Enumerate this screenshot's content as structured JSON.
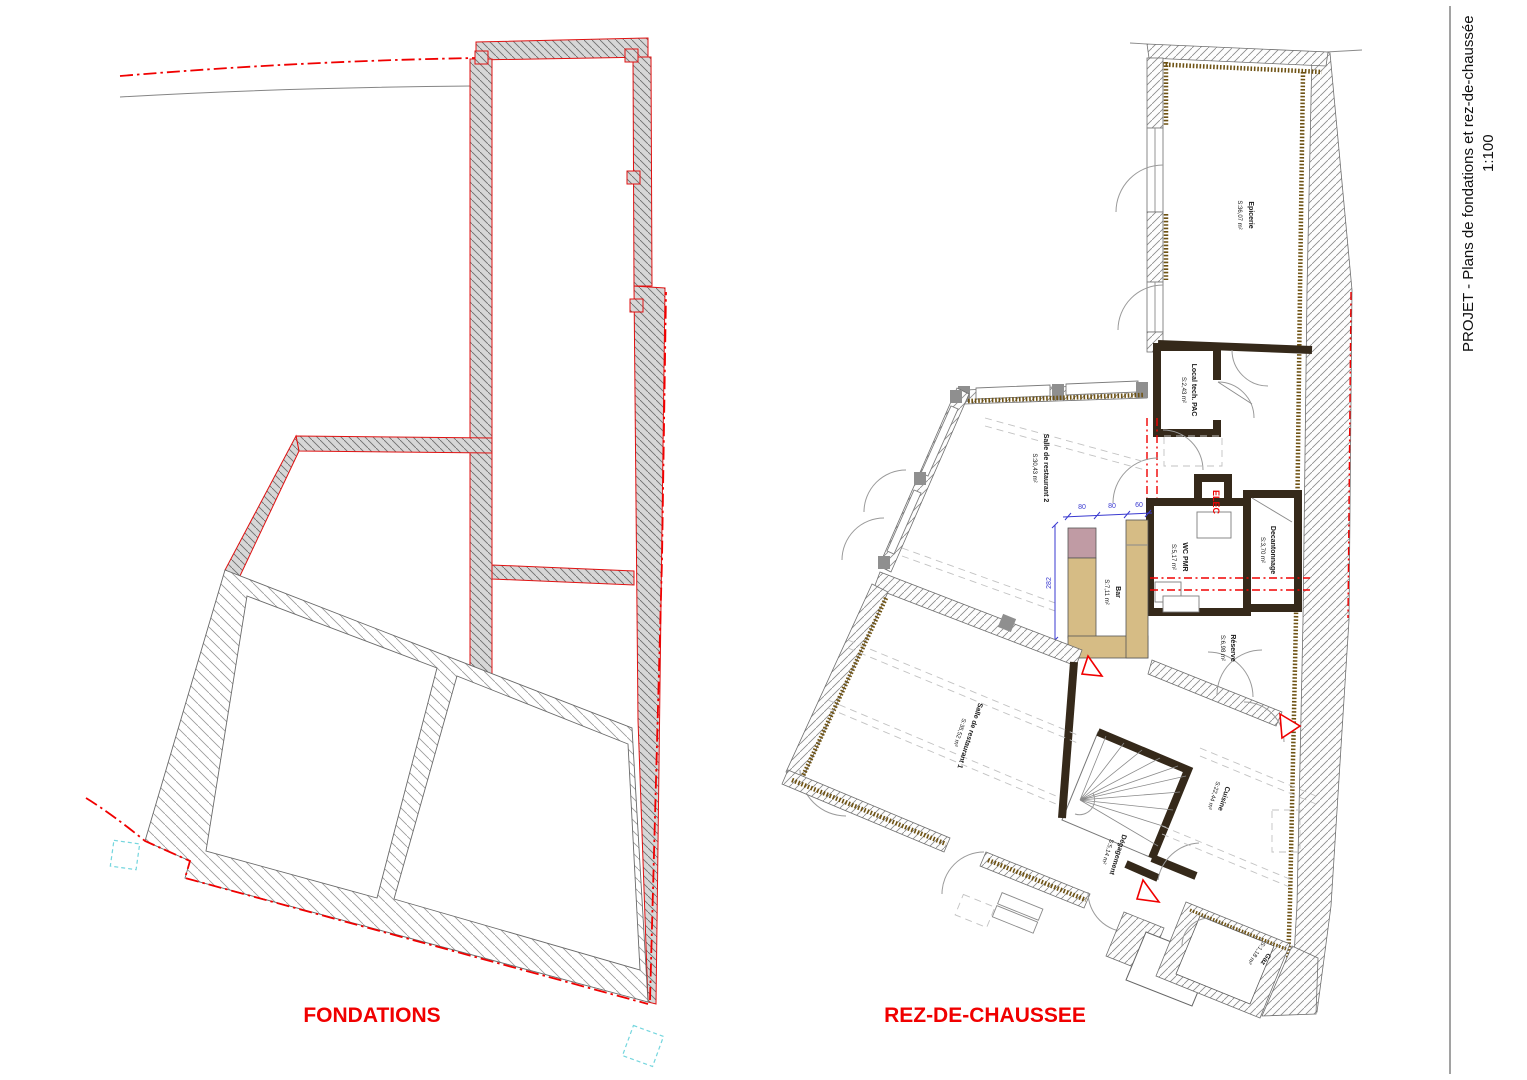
{
  "title_block": {
    "project_title": "PROJET - Plans de fondations et rez-de-chaussée",
    "scale_label": "1:100"
  },
  "plan_labels": {
    "fondations": "FONDATIONS",
    "rdc": "REZ-DE-CHAUSSEE"
  },
  "rooms": {
    "epicerie": {
      "name": "Epicerie",
      "area": "S:36,07 m²"
    },
    "local_tech": {
      "name": "Local tech. PAC",
      "area": "S:2,43 m²"
    },
    "salle2": {
      "name": "Salle de restaurant 2",
      "area": "S:30,43 m²"
    },
    "wc_pmr": {
      "name": "WC PMR",
      "area": "S:5,17 m²"
    },
    "decantonnage": {
      "name": "Decantonnage",
      "area": "S:3,70 m²"
    },
    "bar": {
      "name": "Bar",
      "area": "S:7,11 m²"
    },
    "reserve": {
      "name": "Réserve",
      "area": "S:6,98 m²"
    },
    "salle1": {
      "name": "Salle de restaurant 1",
      "area": "S:35,52 m²"
    },
    "cuisine": {
      "name": "Cuisine",
      "area": "S:22,44 m²"
    },
    "degagement": {
      "name": "Dégagement",
      "area": "S:5,14 m²"
    },
    "gaz": {
      "name": "Gaz",
      "area": "S:1,18 m²"
    },
    "elec": {
      "name": "ELEC"
    }
  },
  "dimensions": {
    "seg1": "80",
    "seg2": "80",
    "seg3": "60",
    "height": "282"
  },
  "colors": {
    "annotation_red": "#f00000",
    "dimension_blue": "#3a3ad0",
    "counter_tan": "#d6bc85",
    "counter_mauve": "#c09ba4",
    "insulation_brown": "#6e5213",
    "survey_cyan": "#74d6de"
  }
}
